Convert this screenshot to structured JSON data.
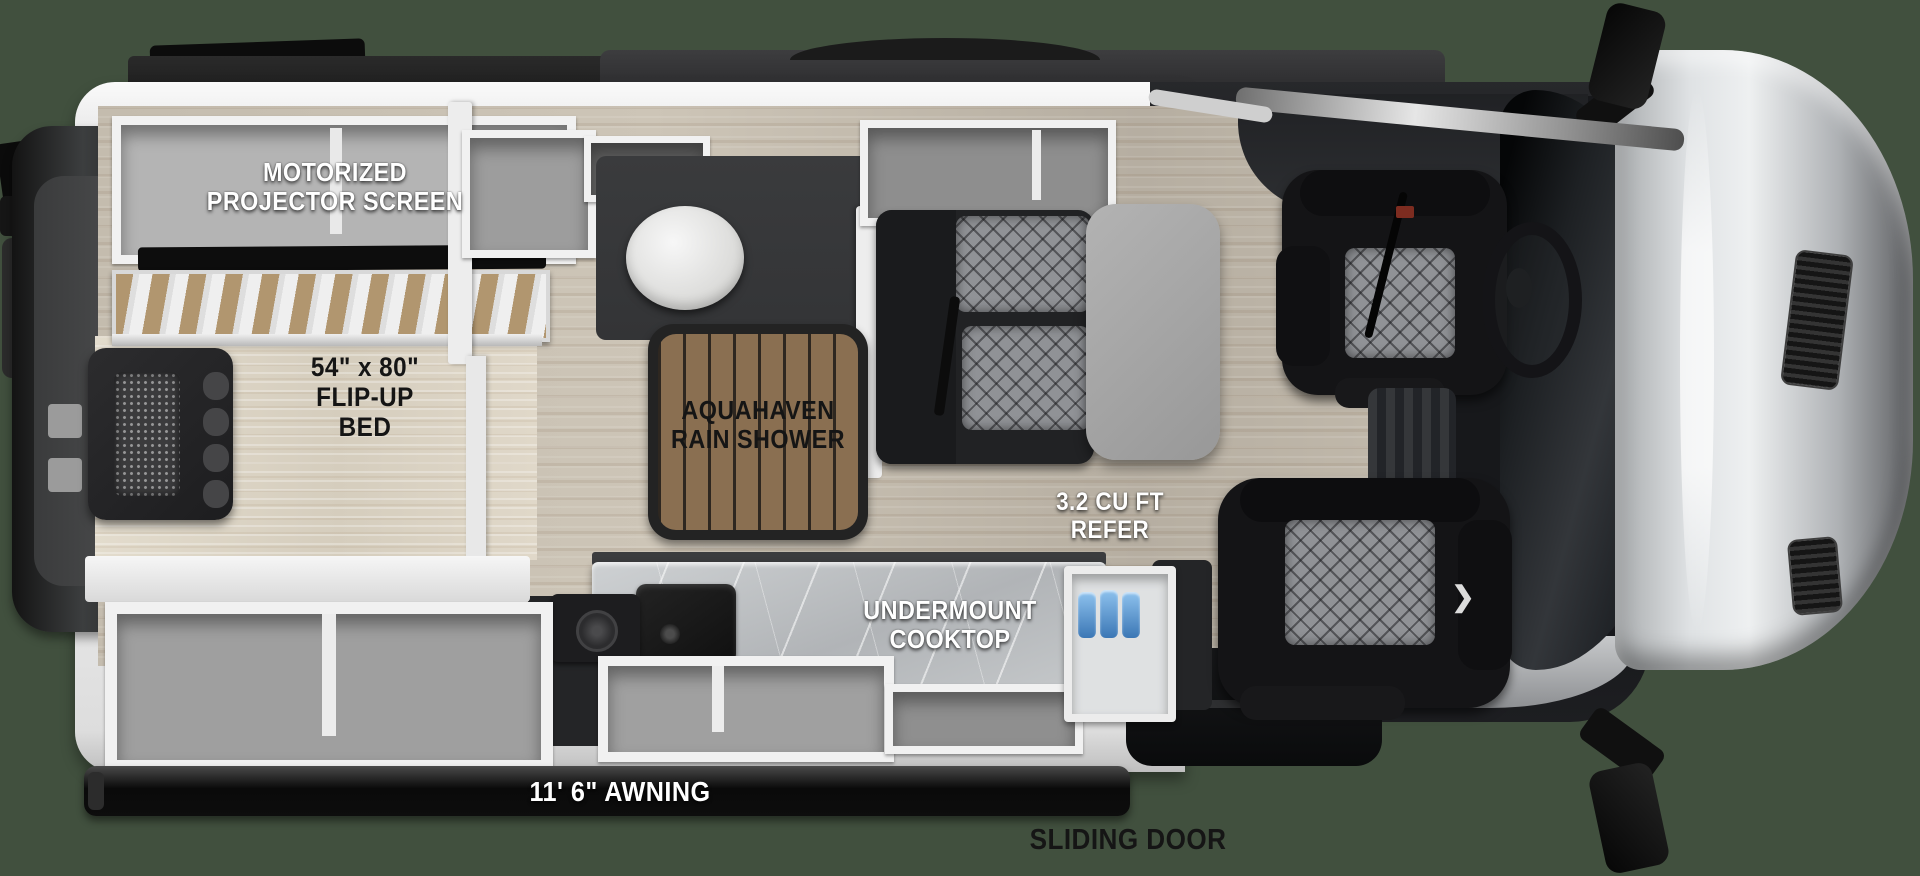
{
  "diagram_type": "rv-camper-van-floorplan-top-view",
  "labels": {
    "projector_screen": {
      "line1": "MOTORIZED",
      "line2": "PROJECTOR SCREEN"
    },
    "flip_up_bed": {
      "line1": "54\" x 80\"",
      "line2": "FLIP-UP",
      "line3": "BED"
    },
    "rain_shower": {
      "line1": "AQUAHAVEN",
      "line2": "RAIN SHOWER"
    },
    "refer": {
      "line1": "3.2 CU FT",
      "line2": "REFER"
    },
    "cooktop": {
      "line1": "UNDERMOUNT",
      "line2": "COOKTOP"
    },
    "awning": {
      "text": "11' 6\" AWNING"
    },
    "sliding_door": {
      "text": "SLIDING DOOR"
    }
  },
  "colors": {
    "background": "#41503e",
    "floor_wood": "#c8c0b2",
    "bed_surface": "#dcd4c5",
    "slat_tan": "#b1966f",
    "shower_mat": "#8a6f51",
    "counter_marble": "#c2c5c7",
    "cabinet_frame": "#f1f1f1",
    "cabinet_interior": "#a6a6a6",
    "seat_black": "#141416",
    "quilt_gray": "#909296",
    "awning_black": "#0d0d0d",
    "hood_silver": "#c6c9cb",
    "van_dark": "#1a1b1e",
    "wall_white": "#ededed",
    "bottle_blue": "#5b9bd4",
    "label_white": "#ffffff",
    "label_black": "#151515"
  }
}
